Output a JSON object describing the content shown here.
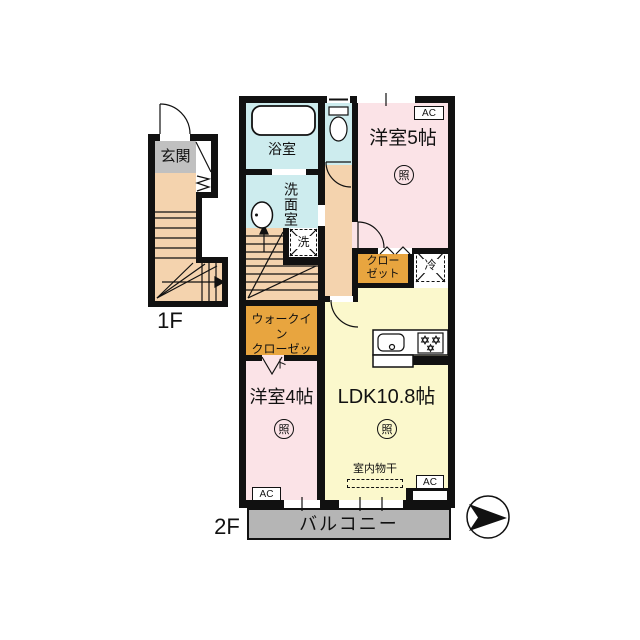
{
  "floor1": {
    "label": "1F",
    "entrance": "玄関"
  },
  "floor2": {
    "label": "2F",
    "bathroom": "浴室",
    "washroom": "洗面室",
    "western5": "洋室5帖",
    "western4": "洋室4帖",
    "ldk": "LDK10.8帖",
    "closet": [
      "クロー",
      "ゼット"
    ],
    "walkin": [
      "ウォークイン",
      "クローゼット"
    ],
    "balcony": "バルコニー",
    "indoor_drying": "室内物干",
    "ac": "AC",
    "light": "照",
    "fridge": "冷",
    "washer": "洗"
  },
  "colors": {
    "wall": "#111111",
    "wet": "#cdecee",
    "bedroom": "#fbe3e7",
    "ldk": "#fbf8cc",
    "hall": "#f4d3ae",
    "closet": "#e8a53f",
    "entrance_floor": "#c0c0c0",
    "balcony": "#b5b5b5"
  }
}
